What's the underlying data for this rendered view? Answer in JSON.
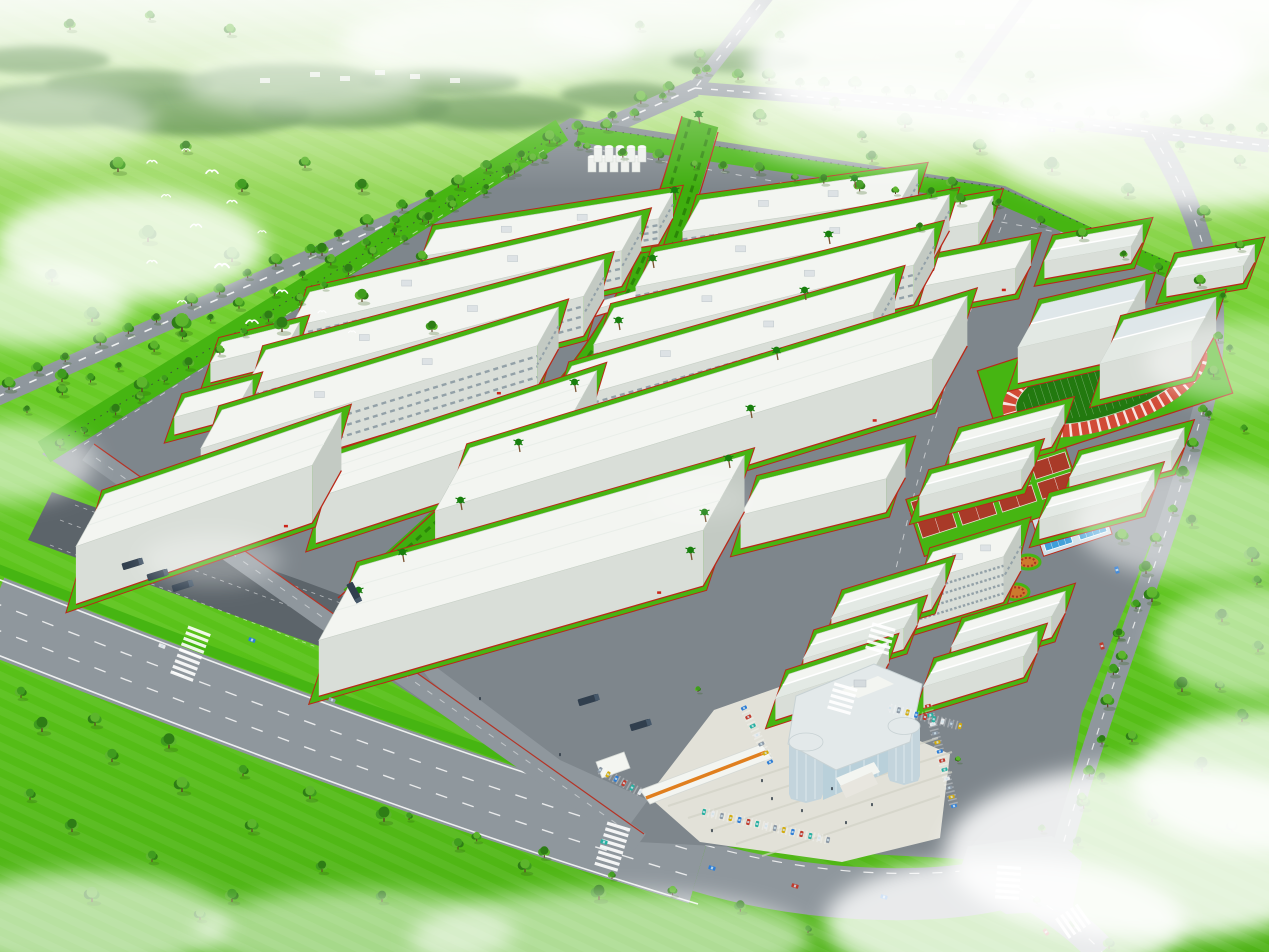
{
  "scene": {
    "type": "aerial-architectural-rendering",
    "subject": "industrial-park-master-plan",
    "colors": {
      "grassTop": "#d9edc8",
      "grassHi": "#8fd64e",
      "grass": "#5ec81e",
      "grassLo": "#4db214",
      "siteGray": "#7e868c",
      "roadGray": "#8f979d",
      "roadDark": "#70787e",
      "lotDark": "#5c646a",
      "lineWhite": "#ffffff",
      "curbRed": "#b92818",
      "verge": "#46b512",
      "boulevGreen": "#3fae0e",
      "hedge": "#2b8608",
      "roofTop": "#f3f5f1",
      "roofShade": "#e3e9e4",
      "roofBlue": "#dfe7ea",
      "wallLight": "#d9ded8",
      "wallDark": "#c3cac3",
      "winStripe": "#93a1a8",
      "redMark": "#cc2418",
      "trackRing": "#d14a36",
      "trackField": "#22790f",
      "courtRed": "#a93a28",
      "poolBlue": "#3f9fd8",
      "poolDeck": "#cfe0e8",
      "flower": "#cc7a2e",
      "flowerDot": "#b03020",
      "treeDark": "#2e7d15",
      "treeMid": "#3f9c1e",
      "treeLight": "#5cb52c",
      "trunk": "#5d4426",
      "palm": "#187f0d",
      "cloud": "#ffffff",
      "bird": "#ffffff",
      "glass": "#b9d0da",
      "glassFrame": "#e3e9ea",
      "towerGlass": "#c3d4dc",
      "orange": "#e07f1f",
      "plaza": "#e2e1d8",
      "plazaLine": "#d2d1c6",
      "truckNavy": "#313f4e",
      "hill": "#a8d58a",
      "treeline": "#3f7d2a",
      "distant": "#e8ece4"
    },
    "car_palette": [
      "#2d7dd6",
      "#c0392b",
      "#27b0a0",
      "#e8eaec",
      "#8d99a6",
      "#d4ac0d"
    ],
    "buildings": [
      [
        "f",
        436,
        230,
        240,
        30,
        26,
        -9,
        1
      ],
      [
        "f",
        310,
        292,
        340,
        40,
        36,
        -13,
        1
      ],
      [
        "f",
        266,
        350,
        350,
        42,
        40,
        -15,
        1
      ],
      [
        "f",
        222,
        410,
        352,
        44,
        42,
        -17,
        1
      ],
      [
        "s",
        340,
        454,
        270,
        50,
        46,
        -18,
        1
      ],
      [
        "s",
        105,
        494,
        250,
        60,
        58,
        -19,
        1
      ],
      [
        "s",
        222,
        342,
        80,
        24,
        20,
        -14,
        0
      ],
      [
        "s",
        185,
        398,
        70,
        22,
        18,
        -15,
        0
      ],
      [
        "f",
        700,
        200,
        220,
        36,
        32,
        -8,
        1
      ],
      [
        "f",
        655,
        252,
        300,
        40,
        36,
        -11,
        1
      ],
      [
        "f",
        614,
        308,
        330,
        42,
        40,
        -14,
        1
      ],
      [
        "f",
        572,
        366,
        336,
        44,
        42,
        -16,
        1
      ],
      [
        "s",
        470,
        448,
        520,
        72,
        50,
        -17,
        1
      ],
      [
        "s",
        360,
        566,
        400,
        85,
        56,
        -16,
        1
      ],
      [
        "s",
        760,
        480,
        150,
        40,
        34,
        -14,
        0
      ],
      [
        "s",
        880,
        216,
        115,
        30,
        24,
        -10,
        0
      ],
      [
        "s",
        918,
        262,
        115,
        32,
        26,
        -11,
        1
      ],
      [
        "g",
        1056,
        240,
        88,
        24,
        18,
        -10,
        0
      ],
      [
        "g",
        1178,
        258,
        78,
        24,
        18,
        -10,
        0
      ],
      [
        "tr",
        1042,
        304,
        106,
        50,
        36,
        -13,
        0
      ],
      [
        "tr",
        1124,
        320,
        95,
        50,
        36,
        -14,
        0
      ],
      [
        "g",
        962,
        432,
        106,
        26,
        20,
        -15,
        0
      ],
      [
        "g",
        932,
        474,
        106,
        26,
        20,
        -15,
        0
      ],
      [
        "g",
        1082,
        455,
        106,
        26,
        20,
        -15,
        0
      ],
      [
        "g",
        1052,
        497,
        106,
        26,
        20,
        -15,
        0
      ],
      [
        "d",
        933,
        552,
        92,
        36,
        46,
        -17,
        0
      ],
      [
        "g",
        845,
        594,
        105,
        28,
        22,
        -17,
        0
      ],
      [
        "g",
        817,
        634,
        105,
        28,
        22,
        -17,
        0
      ],
      [
        "g",
        789,
        674,
        105,
        28,
        22,
        -18,
        0
      ],
      [
        "g",
        965,
        622,
        105,
        28,
        22,
        -17,
        0
      ],
      [
        "g",
        937,
        662,
        105,
        28,
        22,
        -17,
        0
      ],
      [
        "b",
        598,
        302,
        56,
        9,
        7,
        -16,
        0
      ],
      [
        "b",
        386,
        489,
        52,
        9,
        7,
        -18,
        0
      ]
    ],
    "silos": {
      "x": 592,
      "y": 172,
      "rows": 2,
      "cols": 5
    },
    "tree_rows": [
      [
        700,
        78,
        8,
        388,
        24,
        6
      ],
      [
        666,
        102,
        30,
        412,
        22,
        5
      ],
      [
        560,
        146,
        60,
        448,
        20,
        5
      ],
      [
        710,
        76,
        1262,
        134,
        20,
        6
      ],
      [
        590,
        152,
        996,
        208,
        13,
        5
      ],
      [
        1002,
        208,
        1200,
        288,
        6,
        5
      ],
      [
        1226,
        302,
        1206,
        416,
        4,
        5
      ],
      [
        1206,
        416,
        1122,
        640,
        8,
        6
      ],
      [
        1122,
        640,
        1076,
        845,
        7,
        6
      ],
      [
        24,
        700,
        600,
        898,
        9,
        7
      ],
      [
        412,
        822,
        806,
        932,
        7,
        5
      ],
      [
        1040,
        906,
        1108,
        950,
        3,
        5
      ]
    ],
    "trees": [
      [
        118,
        172,
        8
      ],
      [
        186,
        152,
        6
      ],
      [
        242,
        192,
        7
      ],
      [
        305,
        168,
        6
      ],
      [
        362,
        192,
        7
      ],
      [
        148,
        242,
        9
      ],
      [
        232,
        262,
        8
      ],
      [
        322,
        256,
        7
      ],
      [
        92,
        322,
        8
      ],
      [
        182,
        332,
        10
      ],
      [
        282,
        332,
        8
      ],
      [
        362,
        302,
        7
      ],
      [
        422,
        262,
        6
      ],
      [
        432,
        332,
        6
      ],
      [
        62,
        382,
        7
      ],
      [
        142,
        392,
        8
      ],
      [
        52,
        282,
        7
      ],
      [
        395,
        225,
        5
      ],
      [
        760,
        122,
        7
      ],
      [
        835,
        108,
        6
      ],
      [
        905,
        128,
        8
      ],
      [
        980,
        152,
        7
      ],
      [
        1052,
        172,
        8
      ],
      [
        1128,
        196,
        7
      ],
      [
        1204,
        218,
        7
      ],
      [
        872,
        162,
        6
      ],
      [
        952,
        188,
        6
      ],
      [
        1240,
        166,
        6
      ],
      [
        1080,
        130,
        5
      ],
      [
        1180,
        150,
        5
      ],
      [
        1122,
        542,
        7
      ],
      [
        1192,
        526,
        6
      ],
      [
        1252,
        562,
        8
      ],
      [
        1152,
        602,
        8
      ],
      [
        1222,
        622,
        7
      ],
      [
        1258,
        652,
        6
      ],
      [
        1122,
        662,
        6
      ],
      [
        1182,
        692,
        8
      ],
      [
        1242,
        722,
        7
      ],
      [
        1132,
        742,
        6
      ],
      [
        1202,
        772,
        8
      ],
      [
        1152,
        822,
        7
      ],
      [
        1232,
        832,
        6
      ],
      [
        1102,
        782,
        5
      ],
      [
        1257,
        585,
        5
      ],
      [
        1220,
        690,
        5
      ],
      [
        42,
        732,
        8
      ],
      [
        112,
        762,
        7
      ],
      [
        182,
        792,
        8
      ],
      [
        72,
        832,
        7
      ],
      [
        152,
        862,
        6
      ],
      [
        252,
        832,
        7
      ],
      [
        322,
        872,
        6
      ],
      [
        232,
        902,
        7
      ],
      [
        92,
        902,
        8
      ],
      [
        382,
        902,
        6
      ],
      [
        30,
        800,
        6
      ],
      [
        200,
        920,
        6
      ],
      [
        1230,
        352,
        4
      ],
      [
        1244,
        432,
        4
      ],
      [
        1082,
        802,
        5
      ],
      [
        1042,
        832,
        4
      ],
      [
        698,
        692,
        3
      ],
      [
        958,
        762,
        3
      ],
      [
        920,
        230,
        4
      ],
      [
        862,
        140,
        5
      ],
      [
        700,
        60,
        6
      ],
      [
        640,
        30,
        5
      ],
      [
        780,
        40,
        5
      ],
      [
        1240,
        250,
        5
      ],
      [
        70,
        30,
        6
      ],
      [
        150,
        20,
        5
      ],
      [
        230,
        35,
        6
      ],
      [
        960,
        60,
        5
      ],
      [
        1030,
        80,
        5
      ]
    ],
    "palm_paths": [
      [
        [
          700,
          124
        ],
        [
          676,
          200
        ],
        [
          654,
          268
        ],
        [
          620,
          330
        ],
        [
          576,
          392
        ],
        [
          520,
          452
        ],
        [
          462,
          510
        ],
        [
          404,
          562
        ],
        [
          360,
          600
        ]
      ],
      [
        [
          856,
          188
        ],
        [
          830,
          244
        ],
        [
          806,
          300
        ],
        [
          778,
          360
        ],
        [
          752,
          418
        ],
        [
          730,
          468
        ],
        [
          706,
          522
        ],
        [
          692,
          560
        ]
      ]
    ],
    "parking_rows": [
      [
        744,
        708,
        770,
        762,
        7
      ],
      [
        928,
        706,
        954,
        806,
        12
      ],
      [
        704,
        812,
        828,
        840,
        15
      ],
      [
        890,
        708,
        960,
        726,
        9
      ],
      [
        600,
        770,
        640,
        792,
        6
      ]
    ],
    "cars": [
      [
        712,
        868,
        17,
        0
      ],
      [
        795,
        886,
        17,
        1
      ],
      [
        884,
        897,
        16,
        0
      ],
      [
        604,
        842,
        18,
        2
      ],
      [
        1046,
        932,
        55,
        1
      ],
      [
        1102,
        646,
        75,
        1
      ],
      [
        1117,
        570,
        75,
        0
      ],
      [
        332,
        700,
        21,
        4
      ],
      [
        162,
        646,
        21,
        3
      ],
      [
        1052,
        130,
        7,
        4
      ],
      [
        252,
        640,
        21,
        0
      ]
    ],
    "trucks": [
      [
        132,
        564,
        -17
      ],
      [
        157,
        575,
        -17
      ],
      [
        182,
        586,
        -17
      ],
      [
        354,
        592,
        62
      ],
      [
        588,
        700,
        -17
      ],
      [
        640,
        725,
        -17
      ]
    ],
    "people": [
      [
        772,
        800
      ],
      [
        802,
        812
      ],
      [
        832,
        790
      ],
      [
        762,
        782
      ],
      [
        712,
        832
      ],
      [
        872,
        806
      ],
      [
        846,
        824
      ],
      [
        560,
        756
      ],
      [
        480,
        700
      ]
    ],
    "crosswalks": [
      [
        190,
        655,
        21,
        9
      ],
      [
        612,
        848,
        17,
        8
      ],
      [
        1008,
        884,
        4,
        6
      ],
      [
        880,
        640,
        16,
        5
      ],
      [
        842,
        700,
        16,
        5
      ],
      [
        1072,
        922,
        55,
        5
      ]
    ],
    "clouds": [
      [
        130,
        245,
        135,
        55,
        0.8
      ],
      [
        35,
        305,
        95,
        42,
        0.7
      ],
      [
        10,
        462,
        85,
        40,
        0.55
      ],
      [
        490,
        42,
        150,
        38,
        0.7
      ],
      [
        655,
        22,
        120,
        30,
        0.6
      ],
      [
        1000,
        62,
        250,
        78,
        0.85
      ],
      [
        1185,
        142,
        200,
        68,
        0.8
      ],
      [
        885,
        122,
        150,
        48,
        0.55
      ],
      [
        1252,
        32,
        120,
        52,
        0.8
      ],
      [
        1245,
        362,
        100,
        42,
        0.45
      ],
      [
        1205,
        522,
        130,
        58,
        0.5
      ],
      [
        1262,
        642,
        110,
        55,
        0.55
      ],
      [
        1155,
        852,
        210,
        88,
        0.85
      ],
      [
        1005,
        922,
        180,
        65,
        0.8
      ],
      [
        1262,
        782,
        130,
        70,
        0.8
      ],
      [
        610,
        938,
        200,
        48,
        0.55
      ],
      [
        355,
        932,
        160,
        42,
        0.5
      ],
      [
        85,
        922,
        145,
        50,
        0.6
      ],
      [
        55,
        122,
        100,
        38,
        0.45
      ],
      [
        302,
        82,
        120,
        32,
        0.45
      ],
      [
        212,
        560,
        70,
        26,
        0.3
      ],
      [
        700,
        500,
        50,
        18,
        0.18
      ]
    ],
    "birds": [
      [
        152,
        162,
        1
      ],
      [
        186,
        150,
        0.8
      ],
      [
        212,
        172,
        1.2
      ],
      [
        166,
        196,
        0.9
      ],
      [
        232,
        202,
        1
      ],
      [
        196,
        226,
        1.1
      ],
      [
        262,
        232,
        0.8
      ],
      [
        152,
        262,
        1
      ],
      [
        222,
        266,
        1.4
      ],
      [
        282,
        292,
        1.1
      ],
      [
        182,
        302,
        0.9
      ],
      [
        322,
        312,
        0.8
      ],
      [
        252,
        322,
        1.2
      ],
      [
        352,
        332,
        0.7
      ]
    ],
    "treeline": [
      [
        60,
        105,
        95,
        22
      ],
      [
        200,
        112,
        110,
        24
      ],
      [
        350,
        108,
        100,
        20
      ],
      [
        500,
        112,
        85,
        18
      ],
      [
        130,
        85,
        85,
        16
      ],
      [
        290,
        80,
        95,
        16
      ],
      [
        440,
        82,
        80,
        14
      ],
      [
        620,
        95,
        60,
        13
      ],
      [
        740,
        60,
        70,
        12
      ],
      [
        40,
        60,
        70,
        14
      ]
    ],
    "hills": [
      [
        850,
        55,
        320,
        38
      ],
      [
        1150,
        75,
        260,
        45
      ],
      [
        600,
        40,
        200,
        28
      ]
    ],
    "distant_buildings": [
      [
        310,
        72
      ],
      [
        340,
        76
      ],
      [
        375,
        70
      ],
      [
        410,
        74
      ],
      [
        955,
        20
      ],
      [
        985,
        24
      ],
      [
        1015,
        18
      ],
      [
        1050,
        24
      ],
      [
        260,
        78
      ],
      [
        450,
        78
      ]
    ],
    "flower_beds": [
      [
        1028,
        562,
        12,
        7
      ],
      [
        1016,
        592,
        13,
        8
      ],
      [
        988,
        622,
        11,
        7
      ]
    ]
  }
}
